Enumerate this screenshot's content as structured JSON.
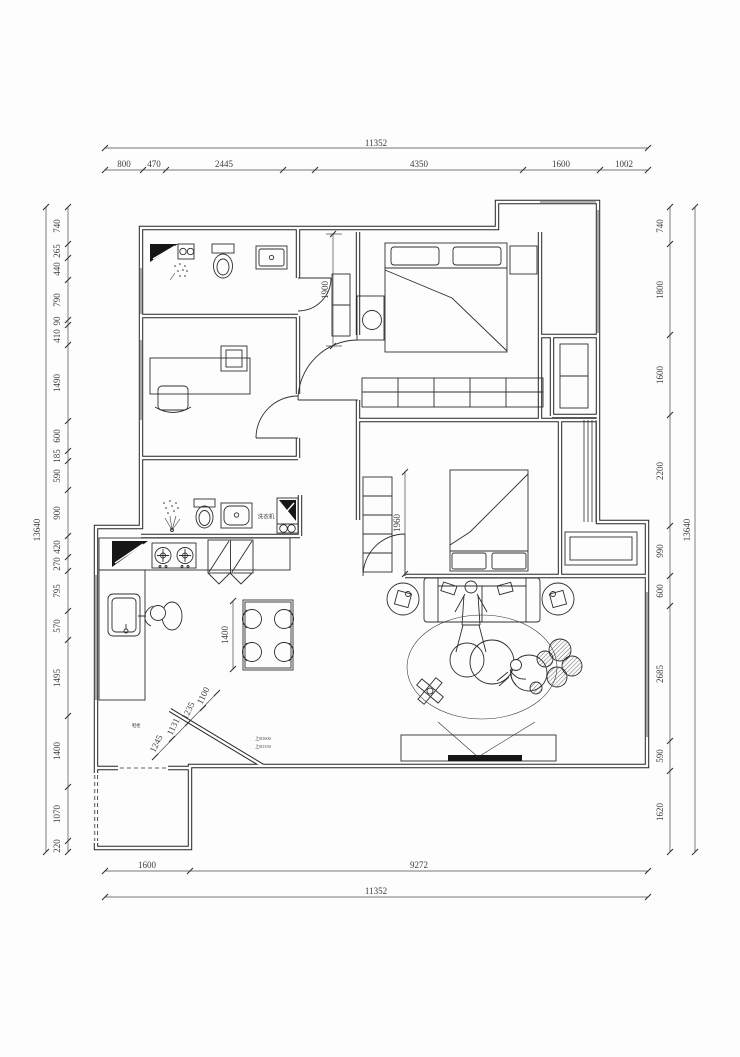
{
  "dims": {
    "top": {
      "overall": "11352",
      "segments": [
        "800",
        "470",
        "2445",
        "4350",
        "1600",
        "1002"
      ]
    },
    "bottom": {
      "overall": "11352",
      "segments": [
        "1600",
        "9272"
      ]
    },
    "left": {
      "overall": "13640",
      "segments": [
        "740",
        "265",
        "440",
        "790",
        "90",
        "410",
        "1490",
        "600",
        "185",
        "590",
        "900",
        "420",
        "270",
        "795",
        "570",
        "1495",
        "1400",
        "1070",
        "220"
      ]
    },
    "right": {
      "overall": "13640",
      "segments": [
        "740",
        "1800",
        "1600",
        "2200",
        "990",
        "600",
        "2685",
        "590",
        "1620"
      ]
    },
    "interior": {
      "corridor": "1900",
      "bedroom2_bed": "1960",
      "dining_table": "1400",
      "entry": [
        "1245",
        "1131",
        "1235",
        "1100"
      ]
    }
  },
  "labels": {
    "washing_machine": "洗衣机",
    "shoe_cabinet": "鞋柜",
    "entry_note_1": "上R1600",
    "entry_note_2": "上R1350"
  }
}
